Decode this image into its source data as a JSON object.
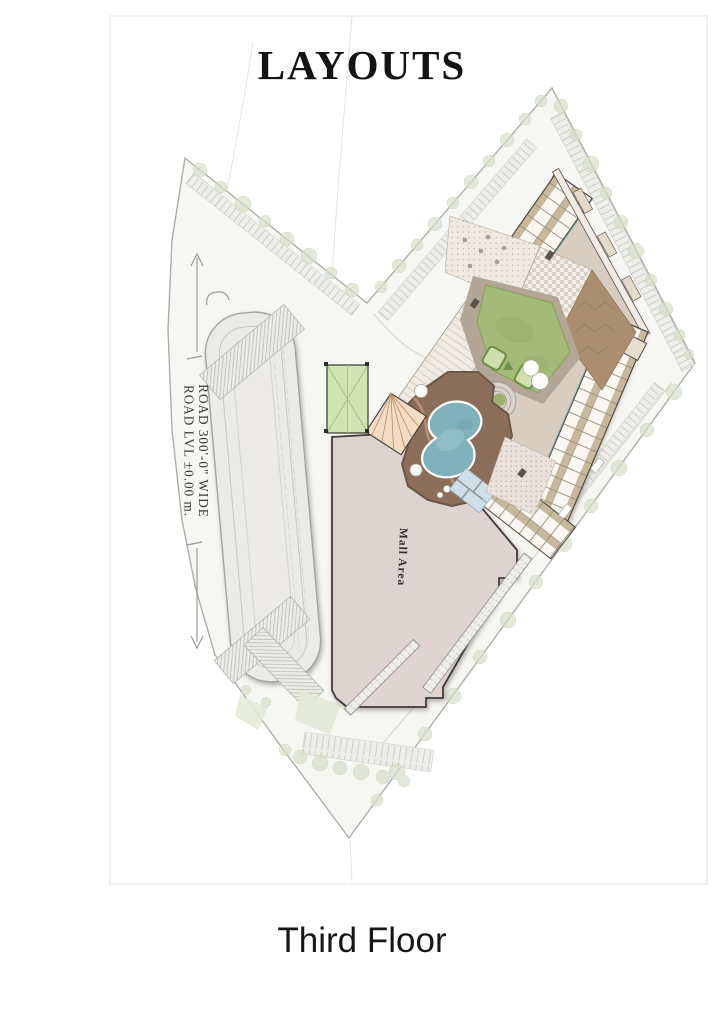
{
  "title": "LAYOUTS",
  "caption": "Third Floor",
  "site_plan": {
    "road": {
      "label_line1": "ROAD  300'-0\"  WIDE",
      "label_line2": "ROAD LVL ±0.00 m."
    },
    "mall": {
      "label": "Mall Area"
    },
    "colors": {
      "site_fill": "#f6f6f3",
      "parcel_outline": "#aeaea8",
      "stadium_fill": "#ebeae6",
      "building_base": "#d8cdbf",
      "unit_balcony": "#c9b89c",
      "lawn": "#a5ba79",
      "pool_water": "#7fb2ba",
      "pool_deck": "#8b6f5a",
      "mall_fill": "#ded3d1",
      "court_green": "#cfe4b2",
      "wood_deck": "#ab8e70",
      "amphitheater": "#f2dcc3",
      "tree": "#d7e0c9"
    }
  }
}
